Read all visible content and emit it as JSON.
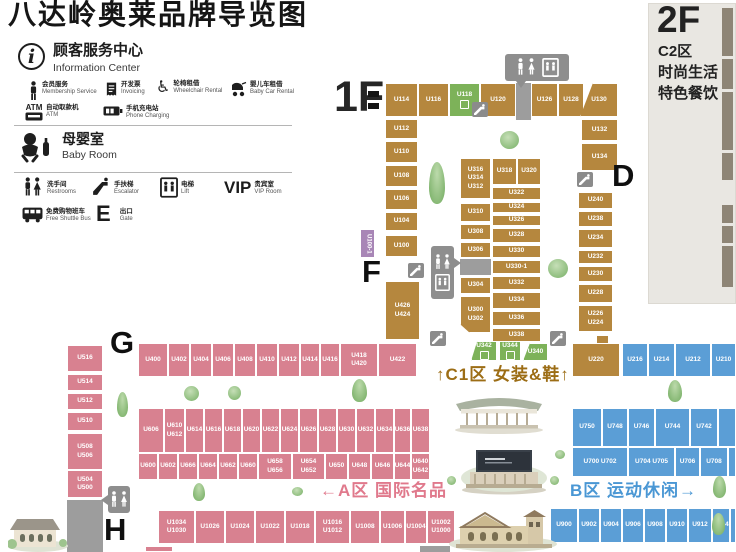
{
  "title": "八达岭奥莱品牌导览图",
  "colors": {
    "brown": "#b5873e",
    "green": "#7db259",
    "pink": "#d88190",
    "blue": "#5b9ed6",
    "purple": "#a886b6",
    "gray": "#9d9d9d",
    "c1_label": "#9c6d15",
    "a_label": "#e0798c",
    "b_label": "#4a97d4"
  },
  "legend": {
    "info": {
      "zh": "顾客服务中心",
      "en": "Information Center"
    },
    "services": [
      {
        "zh": "会员服务",
        "en": "Membership Service"
      },
      {
        "zh": "开发票",
        "en": "Invoicing"
      },
      {
        "zh": "轮椅租借",
        "en": "Wheelchair Rental"
      },
      {
        "zh": "婴儿车租借",
        "en": "Baby Car Rental"
      },
      {
        "zh": "自动取款机",
        "en": "ATM",
        "badge": "ATM"
      },
      {
        "zh": "手机充电站",
        "en": "Phone Charging"
      }
    ],
    "baby": {
      "zh": "母婴室",
      "en": "Baby Room"
    },
    "facilities": [
      {
        "zh": "洗手间",
        "en": "Restrooms"
      },
      {
        "zh": "手扶梯",
        "en": "Escalator"
      },
      {
        "zh": "电梯",
        "en": "Lift"
      },
      {
        "zh": "贵宾室",
        "en": "VIP Room",
        "badge": "VIP"
      },
      {
        "zh": "免费购物班车",
        "en": "Free Shuttle Bus"
      },
      {
        "zh": "出口",
        "en": "Gate",
        "badge": "E"
      }
    ]
  },
  "floors": {
    "f1": "1F",
    "f2": "2F"
  },
  "f2_panel": {
    "zone": "C2区",
    "line1": "时尚生活",
    "line2": "特色餐饮",
    "strips": [
      [
        4,
        48
      ],
      [
        55,
        30
      ],
      [
        88,
        58
      ],
      [
        149,
        27
      ],
      [
        201,
        18
      ],
      [
        222,
        17
      ],
      [
        242,
        41
      ]
    ]
  },
  "map": {
    "zone_labels": [
      {
        "text": "↑C1区 女装&鞋↑",
        "x": 436,
        "y": 360,
        "color": "#9c6d15",
        "size": 17,
        "name": "zone-label-c1"
      },
      {
        "text": "←A区 国际名品",
        "x": 320,
        "y": 476,
        "color": "#e0798c",
        "size": 17,
        "name": "zone-label-a"
      },
      {
        "text": "B区 运动休闲→",
        "x": 570,
        "y": 476,
        "color": "#4a97d4",
        "size": 17,
        "name": "zone-label-b"
      }
    ],
    "gates": [
      [
        "D",
        612,
        160
      ],
      [
        "F",
        362,
        256
      ],
      [
        "G",
        110,
        327
      ],
      [
        "H",
        104,
        514
      ]
    ],
    "escalators": [
      [
        472,
        102
      ],
      [
        408,
        263
      ],
      [
        430,
        331
      ],
      [
        550,
        331
      ],
      [
        577,
        172
      ]
    ],
    "black_bars": [
      [
        368,
        91
      ],
      [
        368,
        103
      ]
    ],
    "trees": [
      [
        "p",
        429,
        162,
        16,
        42
      ],
      [
        "r",
        500,
        131,
        19,
        18
      ],
      [
        "r",
        548,
        259,
        20,
        19
      ],
      [
        "r",
        184,
        386,
        15,
        15
      ],
      [
        "r",
        228,
        386,
        13,
        14
      ],
      [
        "p",
        117,
        392,
        11,
        25
      ],
      [
        "p",
        352,
        379,
        15,
        23
      ],
      [
        "p",
        668,
        380,
        14,
        22
      ],
      [
        "p",
        193,
        483,
        12,
        18
      ],
      [
        "r",
        292,
        487,
        11,
        9
      ],
      [
        "r",
        447,
        476,
        9,
        9
      ],
      [
        "r",
        550,
        476,
        9,
        9
      ],
      [
        "r",
        555,
        450,
        10,
        9
      ],
      [
        "p",
        713,
        476,
        13,
        22
      ],
      [
        "p",
        712,
        513,
        13,
        22
      ]
    ],
    "blocks": [
      [
        "U114",
        385,
        83,
        33,
        34,
        "br"
      ],
      [
        "U116",
        418,
        83,
        31,
        34,
        "br"
      ],
      [
        "U118",
        449,
        83,
        31,
        34,
        "gr",
        {
          "icon": 1
        }
      ],
      [
        "U120",
        480,
        83,
        36,
        34,
        "br"
      ],
      [
        "",
        516,
        83,
        15,
        37,
        "gy"
      ],
      [
        "U126",
        531,
        83,
        27,
        34,
        "br"
      ],
      [
        "U128",
        558,
        83,
        26,
        34,
        "br"
      ],
      [
        "U130",
        580,
        83,
        38,
        34,
        "br",
        {
          "clip": "polygon(34% 0,100% 0,100% 100%,0 100%)"
        }
      ],
      [
        "U112",
        385,
        119,
        33,
        20,
        "br"
      ],
      [
        "U110",
        385,
        141,
        33,
        22,
        "br"
      ],
      [
        "U108",
        385,
        165,
        33,
        22,
        "br"
      ],
      [
        "U106",
        385,
        189,
        33,
        21,
        "br"
      ],
      [
        "U104",
        385,
        212,
        33,
        19,
        "br"
      ],
      [
        "U100",
        385,
        235,
        33,
        22,
        "br"
      ],
      [
        "U100-1",
        360,
        229,
        15,
        29,
        "pu",
        {
          "vert": 1
        }
      ],
      [
        "U426\nU424",
        385,
        281,
        35,
        59,
        "br"
      ],
      [
        "U132",
        581,
        119,
        37,
        22,
        "br"
      ],
      [
        "U134",
        581,
        143,
        37,
        28,
        "br"
      ],
      [
        "U240",
        578,
        192,
        35,
        17,
        "br"
      ],
      [
        "U238",
        578,
        211,
        35,
        16,
        "br"
      ],
      [
        "U234",
        578,
        229,
        35,
        19,
        "br"
      ],
      [
        "U232",
        578,
        250,
        35,
        14,
        "br"
      ],
      [
        "U230",
        578,
        266,
        35,
        16,
        "br"
      ],
      [
        "U228",
        578,
        284,
        35,
        19,
        "br"
      ],
      [
        "U226\nU224",
        578,
        305,
        35,
        27,
        "br"
      ],
      [
        "U220",
        572,
        343,
        48,
        34,
        "br"
      ],
      [
        "",
        596,
        335,
        13,
        9,
        "br"
      ],
      [
        "U316\nU314\nU312",
        460,
        158,
        31,
        41,
        "br"
      ],
      [
        "U310",
        460,
        203,
        31,
        19,
        "br"
      ],
      [
        "U308",
        460,
        224,
        31,
        16,
        "br"
      ],
      [
        "U306",
        460,
        242,
        31,
        16,
        "br"
      ],
      [
        "",
        460,
        259,
        31,
        16,
        "gy"
      ],
      [
        "U304",
        460,
        277,
        31,
        17,
        "br"
      ],
      [
        "U300\nU302",
        460,
        296,
        31,
        37,
        "br",
        {
          "clip": "polygon(0 0,100% 0,100% 100%,32% 100%,0 76%)"
        }
      ],
      [
        "U318",
        492,
        158,
        25,
        27,
        "br"
      ],
      [
        "U320",
        517,
        158,
        24,
        27,
        "br"
      ],
      [
        "U322",
        492,
        187,
        49,
        13,
        "br"
      ],
      [
        "U324",
        492,
        202,
        49,
        11,
        "br"
      ],
      [
        "U326",
        492,
        215,
        49,
        11,
        "br"
      ],
      [
        "U328",
        492,
        228,
        49,
        15,
        "br"
      ],
      [
        "U330",
        492,
        245,
        49,
        13,
        "br"
      ],
      [
        "U330-1",
        492,
        260,
        49,
        14,
        "br"
      ],
      [
        "U332",
        492,
        276,
        49,
        14,
        "br"
      ],
      [
        "U334",
        492,
        292,
        49,
        17,
        "br"
      ],
      [
        "U336",
        492,
        311,
        49,
        15,
        "br"
      ],
      [
        "U338",
        492,
        328,
        49,
        14,
        "br"
      ],
      [
        "U342",
        471,
        341,
        26,
        20,
        "gr",
        {
          "clip": "polygon(24% 0,100% 0,100% 100%,0 100%)",
          "icon": 1
        }
      ],
      [
        "U344",
        499,
        341,
        22,
        20,
        "gr",
        {
          "icon": 1
        }
      ],
      [
        "U340",
        523,
        343,
        25,
        18,
        "gr",
        {
          "clip": "polygon(28% 0,100% 0,100% 100%,0 100%)"
        }
      ],
      [
        "U516",
        67,
        345,
        36,
        27,
        "pk"
      ],
      [
        "U514",
        67,
        374,
        36,
        17,
        "pk"
      ],
      [
        "U512",
        67,
        393,
        36,
        17,
        "pk"
      ],
      [
        "U510",
        67,
        412,
        36,
        19,
        "pk"
      ],
      [
        "U508\nU506",
        67,
        433,
        36,
        37,
        "pk"
      ],
      [
        "U504\nU500",
        67,
        470,
        36,
        28,
        "pk"
      ],
      [
        "",
        67,
        500,
        36,
        52,
        "gy"
      ],
      [
        "U400",
        138,
        343,
        30,
        34,
        "pk"
      ],
      [
        "U402",
        168,
        343,
        22,
        34,
        "pk"
      ],
      [
        "U404",
        190,
        343,
        22,
        34,
        "pk"
      ],
      [
        "U406",
        212,
        343,
        22,
        34,
        "pk"
      ],
      [
        "U408",
        234,
        343,
        22,
        34,
        "pk"
      ],
      [
        "U410",
        256,
        343,
        22,
        34,
        "pk"
      ],
      [
        "U412",
        278,
        343,
        22,
        34,
        "pk"
      ],
      [
        "U414",
        300,
        343,
        20,
        34,
        "pk"
      ],
      [
        "U416",
        320,
        343,
        20,
        34,
        "pk"
      ],
      [
        "U418\nU420",
        340,
        343,
        38,
        34,
        "pk"
      ],
      [
        "U422",
        378,
        343,
        39,
        34,
        "pk"
      ],
      [
        "U606",
        138,
        408,
        26,
        45,
        "pk"
      ],
      [
        "U610\nU612",
        164,
        408,
        21,
        45,
        "pk"
      ],
      [
        "U614",
        185,
        408,
        19,
        45,
        "pk"
      ],
      [
        "U616",
        204,
        408,
        19,
        45,
        "pk"
      ],
      [
        "U618",
        223,
        408,
        19,
        45,
        "pk"
      ],
      [
        "U620",
        242,
        408,
        19,
        45,
        "pk"
      ],
      [
        "U622",
        261,
        408,
        19,
        45,
        "pk"
      ],
      [
        "U624",
        280,
        408,
        19,
        45,
        "pk"
      ],
      [
        "U626",
        299,
        408,
        19,
        45,
        "pk"
      ],
      [
        "U628",
        318,
        408,
        19,
        45,
        "pk"
      ],
      [
        "U630",
        337,
        408,
        19,
        45,
        "pk"
      ],
      [
        "U632",
        356,
        408,
        19,
        45,
        "pk"
      ],
      [
        "U634",
        375,
        408,
        19,
        45,
        "pk"
      ],
      [
        "U636",
        394,
        408,
        17,
        45,
        "pk"
      ],
      [
        "U638",
        411,
        408,
        19,
        45,
        "pk"
      ],
      [
        "U600",
        138,
        453,
        20,
        27,
        "pk"
      ],
      [
        "U602",
        158,
        453,
        20,
        27,
        "pk"
      ],
      [
        "U666",
        178,
        453,
        20,
        27,
        "pk"
      ],
      [
        "U664",
        198,
        453,
        20,
        27,
        "pk"
      ],
      [
        "U662",
        218,
        453,
        20,
        27,
        "pk"
      ],
      [
        "U660",
        238,
        453,
        20,
        27,
        "pk"
      ],
      [
        "U658\nU656",
        258,
        453,
        34,
        27,
        "pk"
      ],
      [
        "U654\nU652",
        292,
        453,
        33,
        27,
        "pk"
      ],
      [
        "U650",
        325,
        453,
        23,
        27,
        "pk"
      ],
      [
        "U648",
        348,
        453,
        23,
        27,
        "pk"
      ],
      [
        "U646",
        371,
        453,
        23,
        27,
        "pk"
      ],
      [
        "U644",
        394,
        453,
        17,
        27,
        "pk"
      ],
      [
        "U640\nU642",
        411,
        453,
        19,
        27,
        "pk"
      ],
      [
        "U1034\nU1030",
        158,
        510,
        37,
        34,
        "pk"
      ],
      [
        "U1026",
        195,
        510,
        30,
        34,
        "pk"
      ],
      [
        "U1024",
        225,
        510,
        30,
        34,
        "pk"
      ],
      [
        "U1022",
        255,
        510,
        30,
        34,
        "pk"
      ],
      [
        "U1018",
        285,
        510,
        30,
        34,
        "pk"
      ],
      [
        "U1016\nU1012",
        315,
        510,
        35,
        34,
        "pk"
      ],
      [
        "U1008",
        350,
        510,
        30,
        34,
        "pk"
      ],
      [
        "U1006",
        380,
        510,
        25,
        34,
        "pk"
      ],
      [
        "U1004",
        405,
        510,
        22,
        34,
        "pk"
      ],
      [
        "U1002\nU1000",
        427,
        510,
        28,
        34,
        "pk"
      ],
      [
        "",
        145,
        546,
        28,
        6,
        "pk"
      ],
      [
        "",
        420,
        546,
        30,
        6,
        "gy"
      ],
      [
        "U216",
        622,
        343,
        26,
        34,
        "bl"
      ],
      [
        "U214",
        648,
        343,
        27,
        34,
        "bl"
      ],
      [
        "U212",
        675,
        343,
        36,
        34,
        "bl"
      ],
      [
        "U210",
        711,
        343,
        25,
        34,
        "bl"
      ],
      [
        "U750",
        572,
        408,
        30,
        39,
        "bl"
      ],
      [
        "U748",
        602,
        408,
        26,
        39,
        "bl"
      ],
      [
        "U746",
        628,
        408,
        27,
        39,
        "bl"
      ],
      [
        "U744",
        655,
        408,
        35,
        39,
        "bl"
      ],
      [
        "U742",
        690,
        408,
        28,
        39,
        "bl"
      ],
      [
        "",
        718,
        408,
        18,
        39,
        "bl"
      ],
      [
        "U700 U702",
        572,
        447,
        56,
        30,
        "bl"
      ],
      [
        "U704 U705",
        628,
        447,
        47,
        30,
        "bl"
      ],
      [
        "U706",
        675,
        447,
        25,
        30,
        "bl"
      ],
      [
        "U708",
        700,
        447,
        28,
        30,
        "bl"
      ],
      [
        "",
        728,
        447,
        8,
        30,
        "bl"
      ],
      [
        "U900",
        550,
        508,
        28,
        35,
        "bl"
      ],
      [
        "U902",
        578,
        508,
        22,
        35,
        "bl"
      ],
      [
        "U904",
        600,
        508,
        22,
        35,
        "bl"
      ],
      [
        "U906",
        622,
        508,
        22,
        35,
        "bl"
      ],
      [
        "U908",
        644,
        508,
        22,
        35,
        "bl"
      ],
      [
        "U910",
        666,
        508,
        22,
        35,
        "bl"
      ],
      [
        "U912",
        688,
        508,
        24,
        35,
        "bl"
      ],
      [
        "U914",
        712,
        508,
        18,
        35,
        "bl"
      ],
      [
        "",
        730,
        508,
        6,
        35,
        "bl"
      ]
    ]
  }
}
